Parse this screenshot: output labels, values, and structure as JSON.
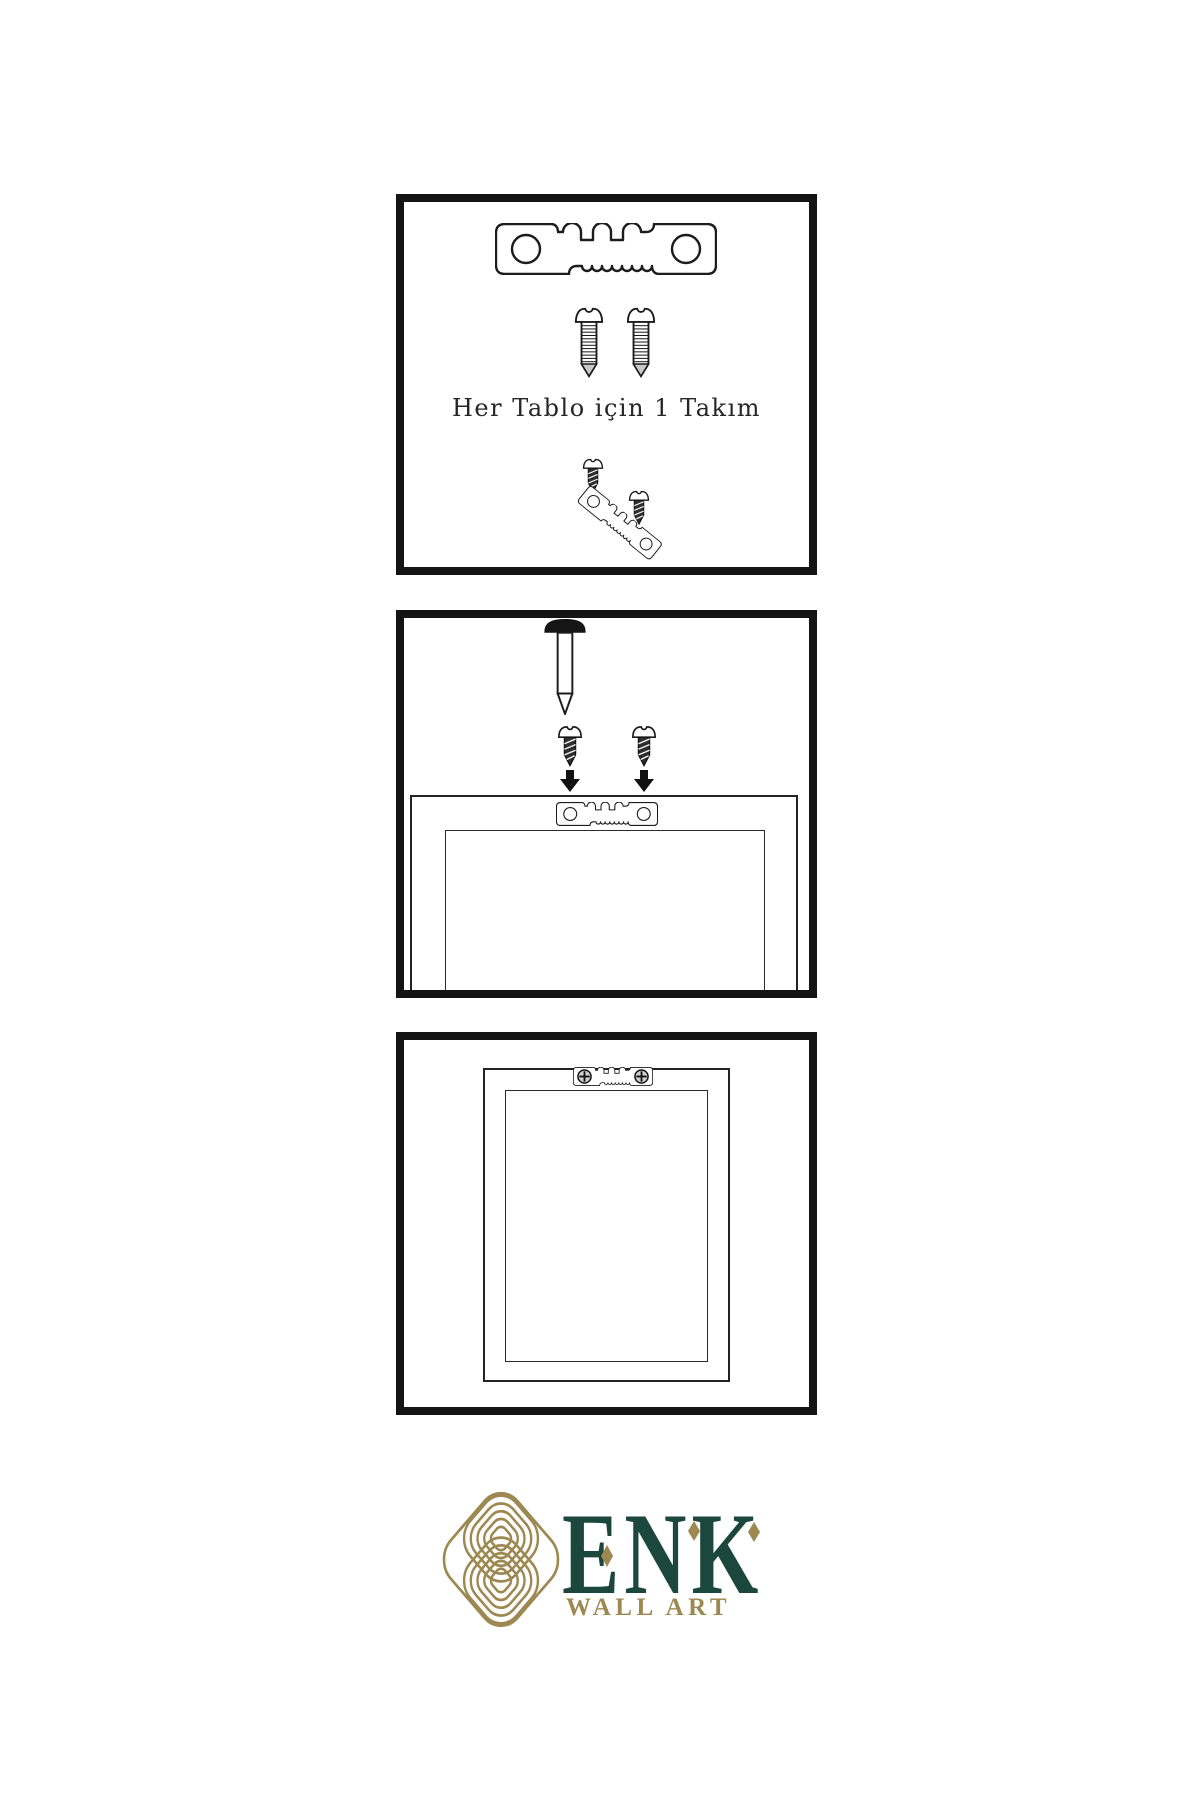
{
  "instructions": {
    "step1_caption": "Her Tablo için 1 Takım"
  },
  "logo": {
    "brand": "ENK",
    "tagline": "WALL ART"
  },
  "colors": {
    "background": "#ffffff",
    "ink": "#1c1c1c",
    "panel_border": "#141414",
    "logo_green": "#1c473c",
    "logo_gold": "#9d8851"
  },
  "icons": {
    "hanger": "sawtooth-hanger-icon",
    "long_screw": "long-screw-icon",
    "short_screw": "short-screw-icon",
    "screw_head": "screw-head-icon",
    "nail": "wall-nail-icon",
    "arrow": "arrow-down-icon",
    "frame": "frame-back-outline",
    "knot": "knot-logo-icon",
    "accent": "diamond-accent"
  }
}
